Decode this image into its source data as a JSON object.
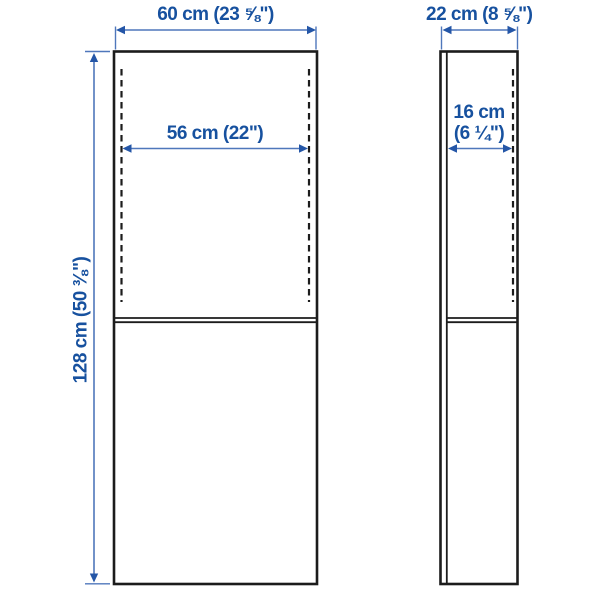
{
  "diagram": {
    "description": "Two-view furniture dimension drawing (front view and side view of a tall cabinet)",
    "views": {
      "front": {
        "width_label": "60 cm (23 ⅝\")",
        "inner_width_label": "56 cm (22\")",
        "height_label": "128 cm (50 ⅜\")"
      },
      "side": {
        "depth_label": "22 cm (8 ⅝\")",
        "inner_depth_label_line1": "16 cm",
        "inner_depth_label_line2": "(6 ¼\")"
      }
    },
    "colors": {
      "outline_black": "#1c1c1c",
      "dimension_text_blue": "#17519f",
      "dimension_line_blue": "#4f77bb",
      "arrowhead_blue": "#2456a7",
      "background": "#ffffff"
    }
  }
}
